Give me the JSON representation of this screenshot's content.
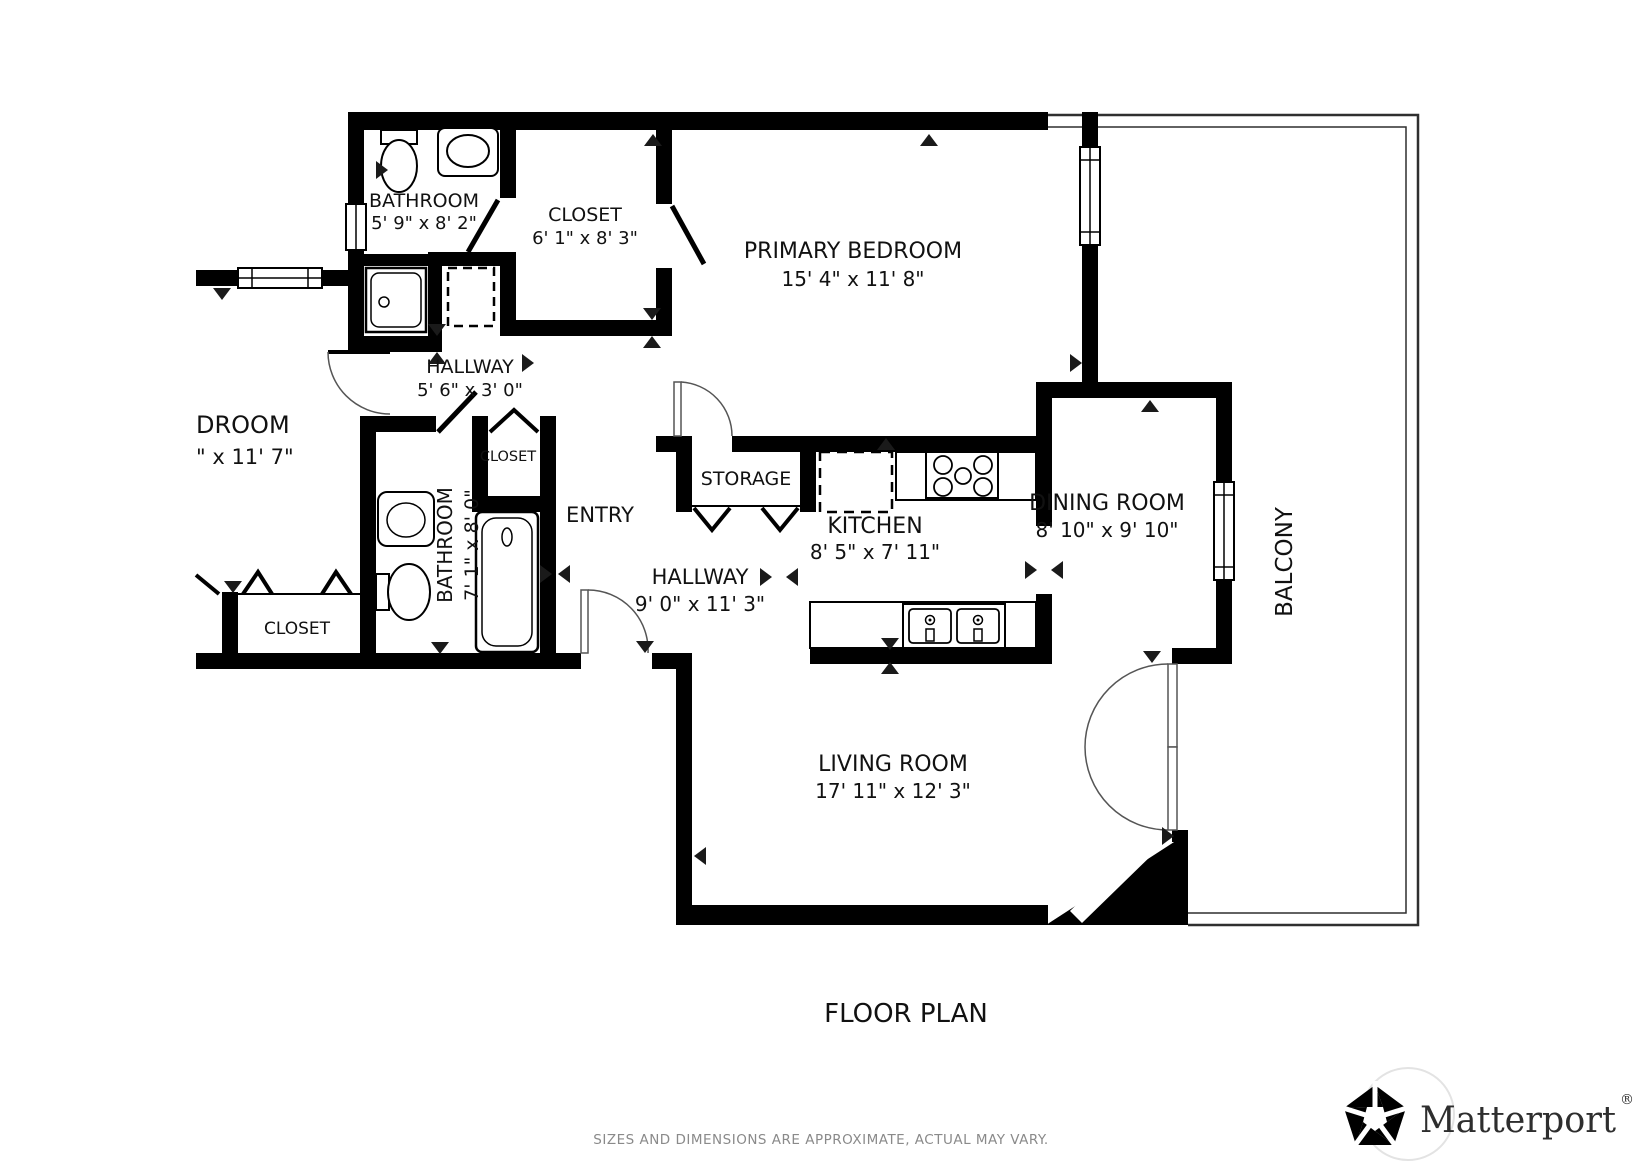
{
  "title": "FLOOR PLAN",
  "disclaimer": "SIZES AND DIMENSIONS ARE APPROXIMATE, ACTUAL MAY VARY.",
  "brand": {
    "name": "Matterport",
    "registered": "®"
  },
  "colors": {
    "wall": "#000000",
    "background": "#ffffff",
    "thin_line": "#2f2f2f",
    "door_arc": "#555555",
    "disclaimer_text": "#8a8a8a",
    "brand_text": "#2e2e2e"
  },
  "rooms": [
    {
      "id": "bathroom-top",
      "name": "BATHROOM",
      "dims": "5' 9\" x 8' 2\""
    },
    {
      "id": "closet-top",
      "name": "CLOSET",
      "dims": "6' 1\" x 8' 3\""
    },
    {
      "id": "primary-bedroom",
      "name": "PRIMARY BEDROOM",
      "dims": "15' 4\" x 11' 8\""
    },
    {
      "id": "hallway-upper",
      "name": "HALLWAY",
      "dims": "5' 6\" x 3' 0\""
    },
    {
      "id": "bedroom-partial",
      "name": "DROOM",
      "dims": "\" x 11' 7\""
    },
    {
      "id": "closet-small",
      "name": "CLOSET",
      "dims": ""
    },
    {
      "id": "bathroom-lower",
      "name": "BATHROOM",
      "dims": "7' 1\" x 8' 0\""
    },
    {
      "id": "entry",
      "name": "ENTRY",
      "dims": ""
    },
    {
      "id": "storage",
      "name": "STORAGE",
      "dims": ""
    },
    {
      "id": "hallway-lower",
      "name": "HALLWAY",
      "dims": "9' 0\" x 11' 3\""
    },
    {
      "id": "kitchen",
      "name": "KITCHEN",
      "dims": "8' 5\" x 7' 11\""
    },
    {
      "id": "dining-room",
      "name": "DINING ROOM",
      "dims": "8' 10\" x 9' 10\""
    },
    {
      "id": "living-room",
      "name": "LIVING ROOM",
      "dims": "17' 11\" x 12' 3\""
    },
    {
      "id": "closet-bottom-left",
      "name": "CLOSET",
      "dims": ""
    },
    {
      "id": "balcony",
      "name": "BALCONY",
      "dims": ""
    }
  ]
}
